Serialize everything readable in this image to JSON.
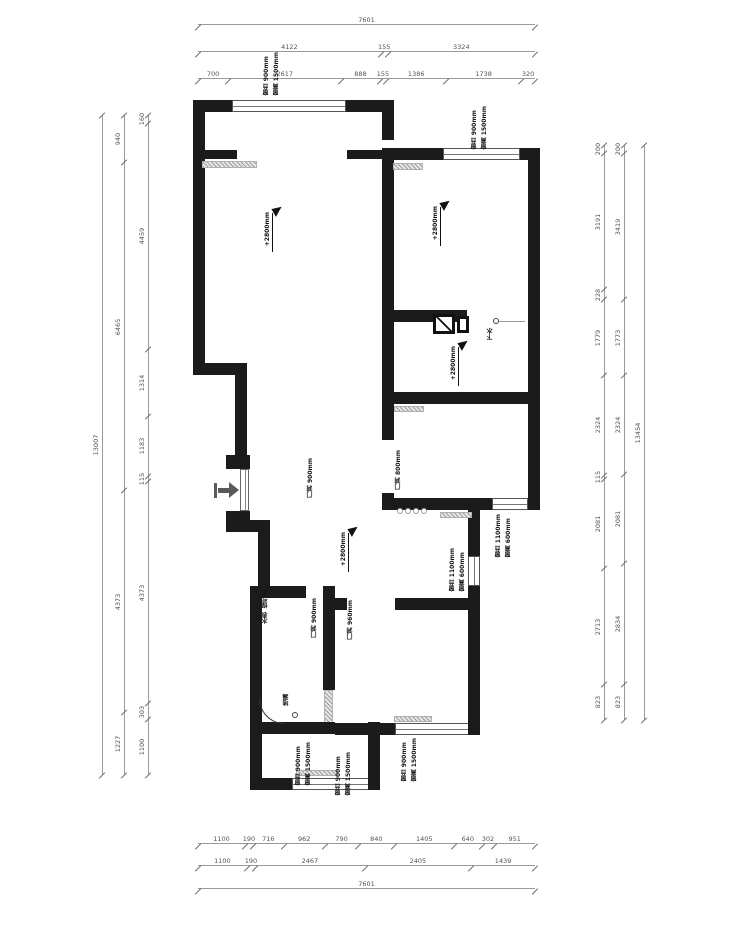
{
  "dims": {
    "top": {
      "total": [
        "7601"
      ],
      "mid": [
        "4122",
        "155",
        "3324"
      ],
      "inner": [
        "700",
        "2617",
        "888",
        "155",
        "1386",
        "1738",
        "320"
      ]
    },
    "bottom": {
      "inner": [
        "1100",
        "190",
        "716",
        "962",
        "790",
        "840",
        "1405",
        "640",
        "302",
        "951"
      ],
      "mid": [
        "1100",
        "190",
        "2467",
        "2405",
        "1439"
      ],
      "total": [
        "7601"
      ]
    },
    "left": {
      "total": [
        "13007"
      ],
      "mid": [
        "940",
        "6465",
        "4373",
        "1227"
      ],
      "inner": [
        "160",
        "4459",
        "1314",
        "1183",
        "115",
        "4373",
        "303",
        "1100"
      ]
    },
    "right": {
      "inner": [
        "200",
        "3191",
        "228",
        "1779",
        "2324",
        "115",
        "2081",
        "2713",
        "823"
      ],
      "mid": [
        "200",
        "3419",
        "1773",
        "2324",
        "2081",
        "2834",
        "823"
      ],
      "total": [
        "13454"
      ]
    }
  },
  "annotations": {
    "elevation": "+2800mm",
    "sill_900": "窗台 900mm",
    "head_1500": "窗高 1500mm",
    "sill_1100": "窗台 1100mm",
    "head_600": "窗高 600mm",
    "door_900": "门洞 900mm",
    "door_960": "门洞 960mm",
    "door_800": "门洞 800mm",
    "drain": "下水",
    "gas_meter": "煤气表",
    "water_meter": "水表",
    "floor_drain": "地漏"
  },
  "colors": {
    "wall": "#1b1b1b",
    "dim_line": "#9a9a9a",
    "hatch": "#b0b0b0",
    "text": "#3c3c3c"
  }
}
